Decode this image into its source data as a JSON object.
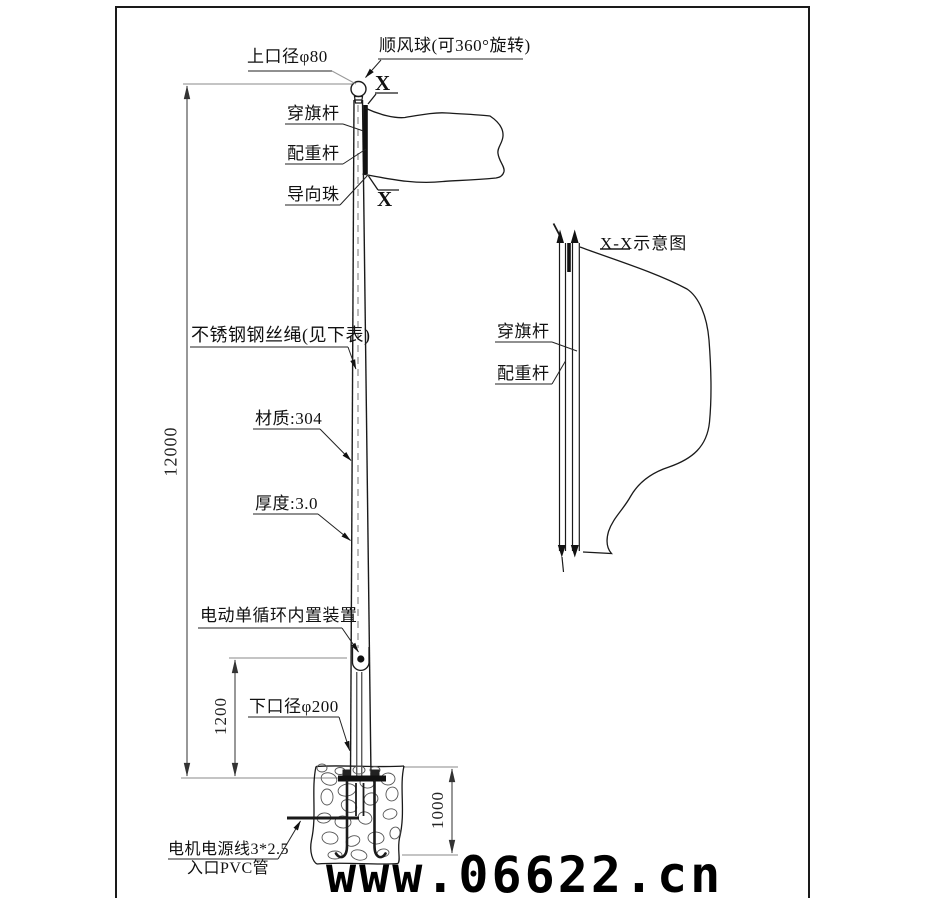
{
  "page": {
    "background": "#ffffff",
    "line_color": "#1a1a1a"
  },
  "labels": {
    "top_diameter": "上口径φ80",
    "wind_ball": "顺风球(可360°旋转)",
    "flag_rod": "穿旗杆",
    "counterweight_rod": "配重杆",
    "guide_bead": "导向珠",
    "wire_rope": "不锈钢钢丝绳(见下表)",
    "material": "材质:304",
    "thickness": "厚度:3.0",
    "motor_device": "电动单循环内置装置",
    "bottom_diameter": "下口径φ200",
    "power_cable": "电机电源线3*2.5",
    "pvc_inlet": "入口PVC管",
    "section_marker": "X"
  },
  "dimensions": {
    "pole_height": "12000",
    "lower_section": "1200",
    "foundation_depth": "1000"
  },
  "section_view": {
    "title": "X-X示意图",
    "flag_rod": "穿旗杆",
    "counterweight_rod": "配重杆"
  },
  "watermark": "www.06622.cn"
}
